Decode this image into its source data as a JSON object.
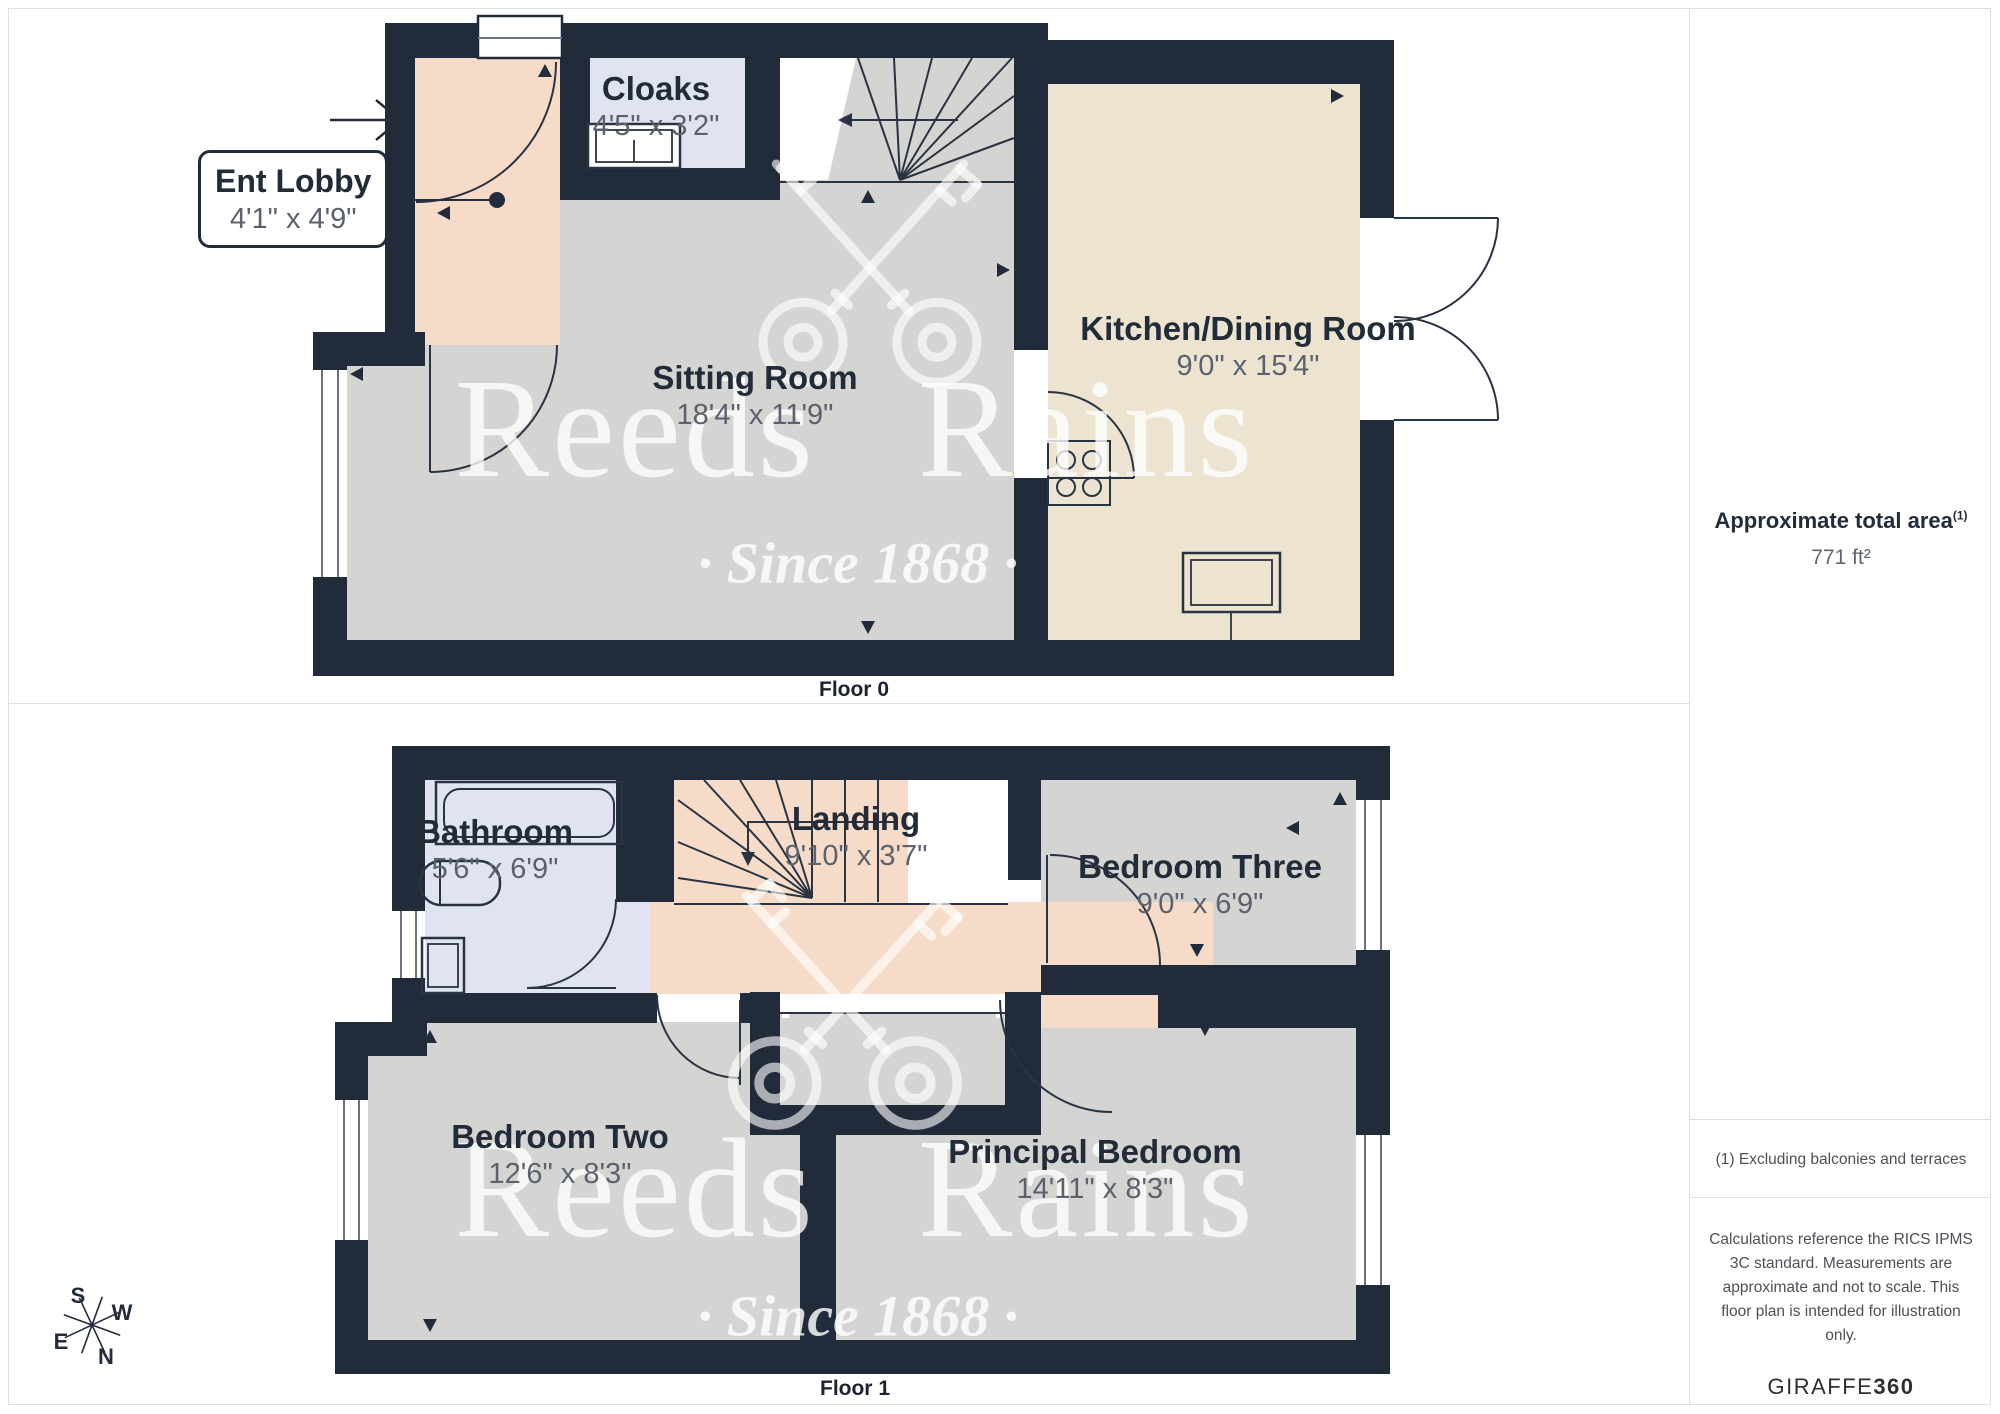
{
  "floor0": {
    "label": "Floor 0",
    "rooms": {
      "ent_lobby": {
        "name": "Ent Lobby",
        "dims": "4'1\" x 4'9\""
      },
      "cloaks": {
        "name": "Cloaks",
        "dims": "4'5\" x 3'2\""
      },
      "sitting_room": {
        "name": "Sitting Room",
        "dims": "18'4\" x 11'9\""
      },
      "kitchen_dining": {
        "name": "Kitchen/Dining Room",
        "dims": "9'0\" x 15'4\""
      }
    }
  },
  "floor1": {
    "label": "Floor 1",
    "rooms": {
      "bathroom": {
        "name": "Bathroom",
        "dims": "5'6\" x 6'9\""
      },
      "landing": {
        "name": "Landing",
        "dims": "9'10\" x 3'7\""
      },
      "bedroom_three": {
        "name": "Bedroom Three",
        "dims": "9'0\" x 6'9\""
      },
      "bedroom_two": {
        "name": "Bedroom Two",
        "dims": "12'6\" x 8'3\""
      },
      "principal_bedroom": {
        "name": "Principal Bedroom",
        "dims": "14'11\" x 8'3\""
      }
    }
  },
  "watermark": {
    "brand": "Reeds Rains",
    "tagline": "· Since 1868 ·"
  },
  "sidebar": {
    "area_title": "Approximate total area",
    "area_note_ref": "(1)",
    "area_value": "771 ft²",
    "footnote": "(1) Excluding balconies and terraces",
    "disclaimer": "Calculations reference the RICS IPMS 3C standard. Measurements are approximate and not to scale. This floor plan is intended for illustration only.",
    "provider": "GIRAFFE",
    "provider_suffix": "360"
  },
  "compass": {
    "north": "N",
    "south": "S",
    "east": "E",
    "west": "W"
  },
  "colors": {
    "wall": "#212b3a",
    "room_gray": "#d4d4d2",
    "room_peach": "#f6dcc8",
    "room_lavender": "#e0e4f0",
    "room_cream": "#ece4d0",
    "watermark": "#ffffff"
  }
}
